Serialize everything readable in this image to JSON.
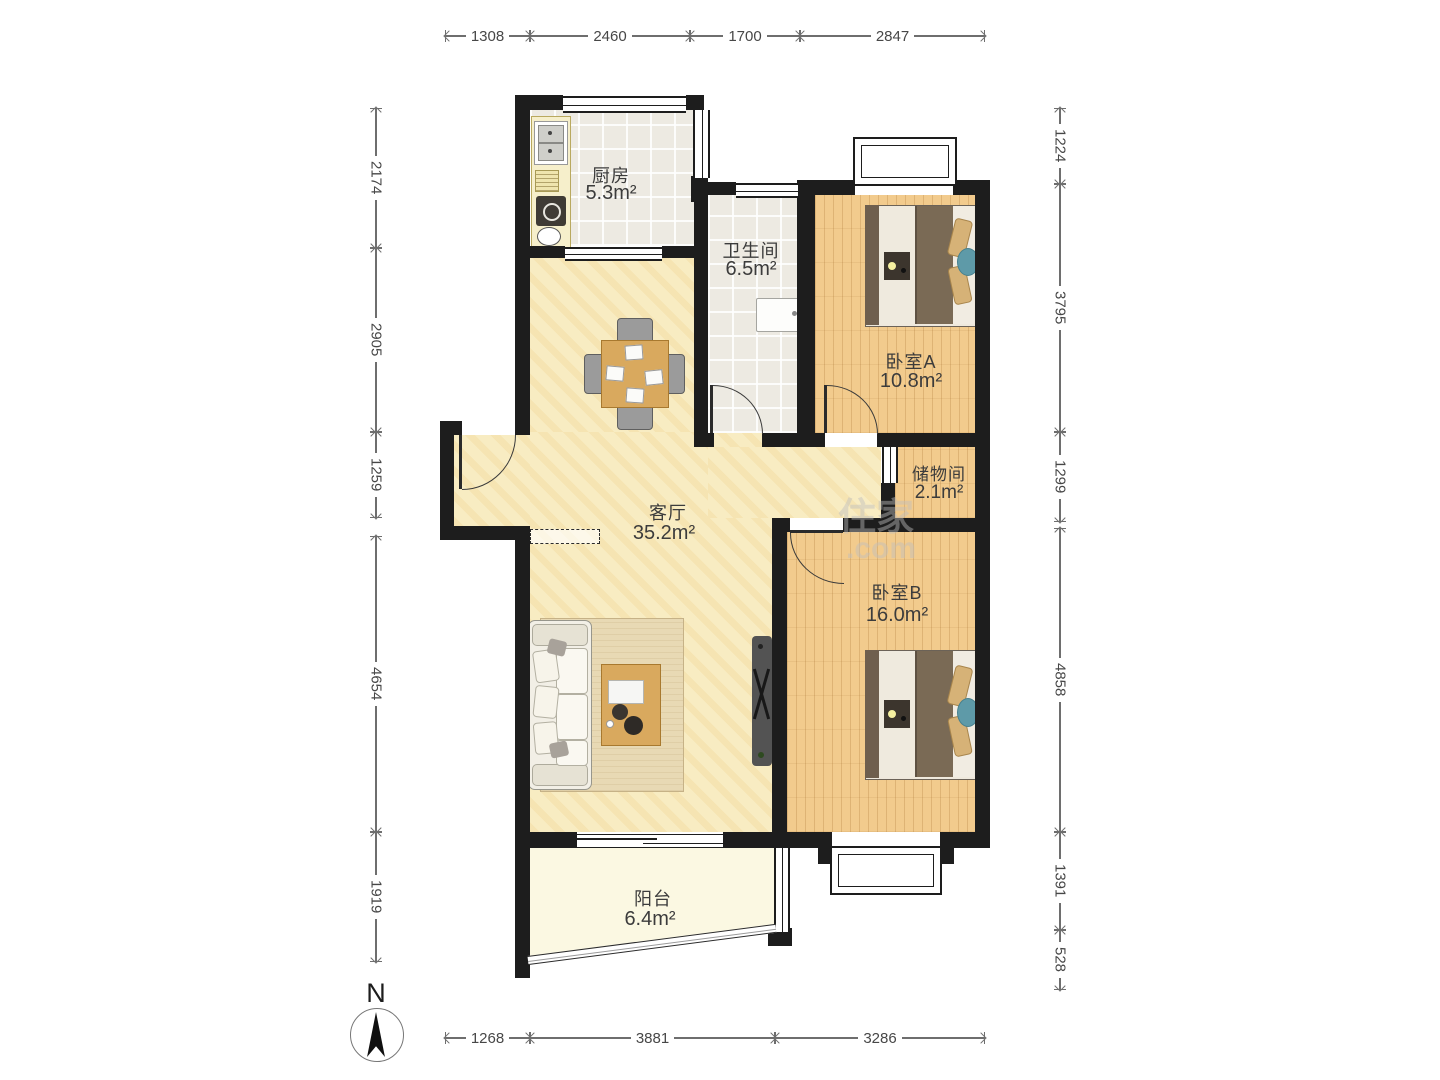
{
  "rooms": {
    "kitchen": {
      "name": "厨房",
      "area": "5.3m²"
    },
    "bathroom": {
      "name": "卫生间",
      "area": "6.5m²"
    },
    "bedroom_a": {
      "name": "卧室A",
      "area": "10.8m²"
    },
    "storage": {
      "name": "储物间",
      "area": "2.1m²"
    },
    "living": {
      "name": "客厅",
      "area": "35.2m²"
    },
    "bedroom_b": {
      "name": "卧室B",
      "area": "16.0m²"
    },
    "balcony": {
      "name": "阳台",
      "area": "6.4m²"
    }
  },
  "dimensions": {
    "top": [
      "1308",
      "2460",
      "1700",
      "2847"
    ],
    "bottom": [
      "1268",
      "3881",
      "3286"
    ],
    "left": [
      "2174",
      "2905",
      "1259",
      "4654",
      "1919"
    ],
    "right": [
      "1224",
      "3795",
      "1299",
      "4858",
      "1391",
      "528"
    ]
  },
  "compass": {
    "label": "N"
  },
  "watermark": {
    "brand": "住家",
    "domain": ".com"
  },
  "colors": {
    "wall": "#1d1d1d",
    "wood_floor": "#f2cb8d",
    "living_floor": "#f8ecc2",
    "tile_floor": "#edeae2",
    "balcony_floor": "#fbf8e2",
    "blanket": "#7a6a55",
    "pillow": "#d6b277",
    "accent_pillow": "#5e9aa8",
    "table_wood": "#d9a95e"
  }
}
